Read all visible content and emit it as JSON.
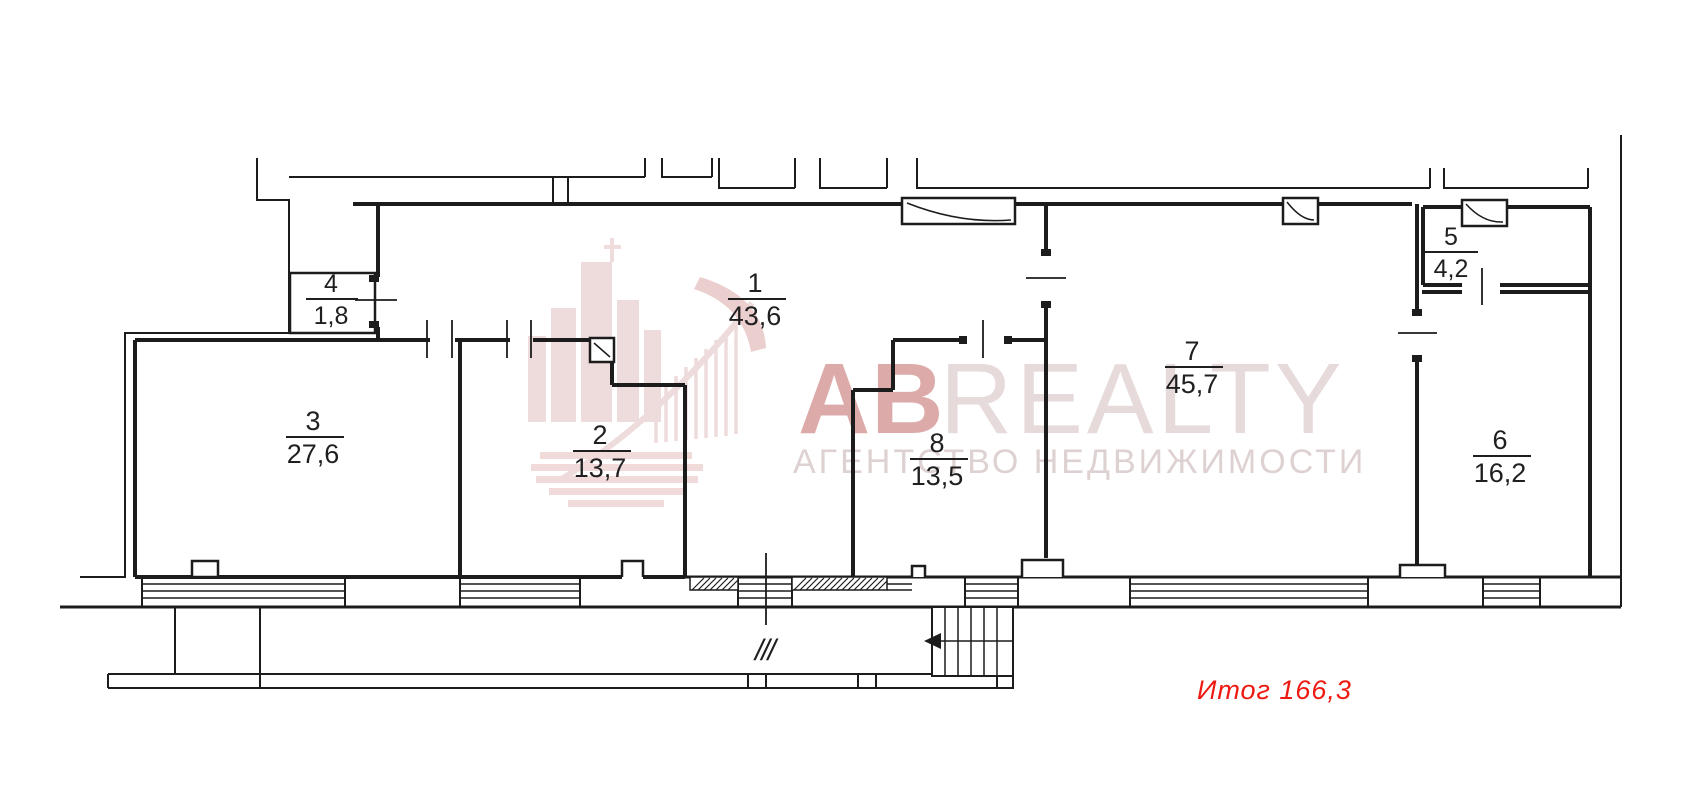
{
  "document": {
    "type": "floor-plan",
    "background": "#ffffff",
    "line_color": "#1c1c1c"
  },
  "rooms": [
    {
      "number": "1",
      "area": "43,6"
    },
    {
      "number": "2",
      "area": "13,7"
    },
    {
      "number": "3",
      "area": "27,6"
    },
    {
      "number": "4",
      "area": "1,8"
    },
    {
      "number": "5",
      "area": "4,2"
    },
    {
      "number": "6",
      "area": "16,2"
    },
    {
      "number": "7",
      "area": "45,7"
    },
    {
      "number": "8",
      "area": "13,5"
    }
  ],
  "total": {
    "text": "Итог 166,3",
    "color": "#ee1a12"
  },
  "annotations": {
    "entrance_mark": "///"
  },
  "watermark": {
    "brand_bold": "AB",
    "brand_light": "REALTY",
    "tagline": "АГЕНТСТВО  НЕДВИЖИМОСТИ",
    "accent_color": "#c98a8a"
  }
}
